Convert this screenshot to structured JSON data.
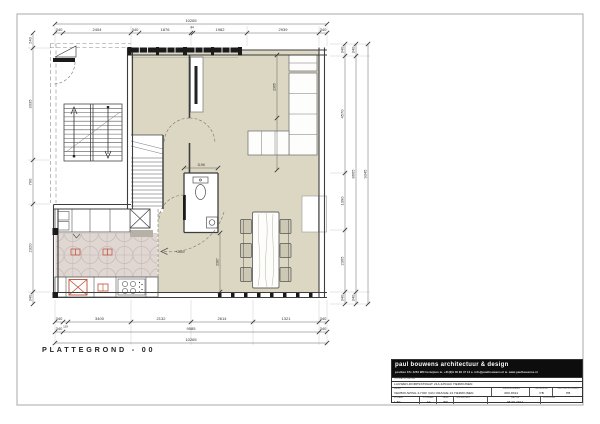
{
  "plan": {
    "title": "PLATTEGROND - 00",
    "level_marker": "+2600"
  },
  "dims": {
    "top": [
      "340",
      "2404",
      "340",
      "1876",
      "44",
      "1982",
      "2939",
      "340"
    ],
    "top_total": "10265",
    "b1": [
      "340",
      "118",
      "3400",
      "2132",
      "2614",
      "1321",
      "340"
    ],
    "b2": [
      "340",
      "9585",
      "340"
    ],
    "b3": "10265",
    "left": [
      "240",
      "3335",
      "790",
      "2320",
      "340"
    ],
    "r1": [
      "340",
      "4570",
      "1390",
      "2365",
      "340"
    ],
    "r2": [
      "340",
      "8665",
      "340"
    ],
    "r3": "9345",
    "living_v": "2365",
    "dining_v": "2387",
    "wc_w": "1196"
  },
  "titleblock": {
    "firm": "paul bouwens architectuur & design",
    "contact": "postbus 67c 4254 WN herwijnen   m. +31(0)6 48 96 47 12   e. info@paulbouwens.nl   w. www.paulbouwens.nl",
    "opdrachtgever_label": "OPDRACHTGEVER",
    "opdrachtgever": "LAUWEN-DORPSSTRAAT 21A 4254AC HERWIJNEN",
    "werk_label": "WERK",
    "werk": "VERBOUWING 2-HOF VAN ORANJE 24 HERWIJNEN",
    "werknummer_label": "WERKNUMMER",
    "werknummer": "080-8321",
    "getekend_label": "GETEKEND",
    "getekend": "PB",
    "gecontroleerd_label": "GECONTROLEERD",
    "gecontroleerd": "PB",
    "schaal_label": "SCHAAL",
    "schaal": "1:50",
    "formaat_label": "FORMAAT",
    "formaat": "A3",
    "fase_label": "FASE",
    "fase": "BD",
    "onderdeel_label": "ONDERDEEL",
    "onderdeel": "",
    "datum_label": "DATUM",
    "datum": "08 09 2014",
    "wijziging_label": "WIJZIGING",
    "wijziging": ""
  },
  "colors": {
    "floor_beige": "#dbd7c3",
    "tile_pink": "#e0d6d2",
    "accent_red": "#bf4b32",
    "wall": "#3d3d3d",
    "frame_gray": "#a9a9a9",
    "titleblock_black": "#0d0d0d"
  }
}
